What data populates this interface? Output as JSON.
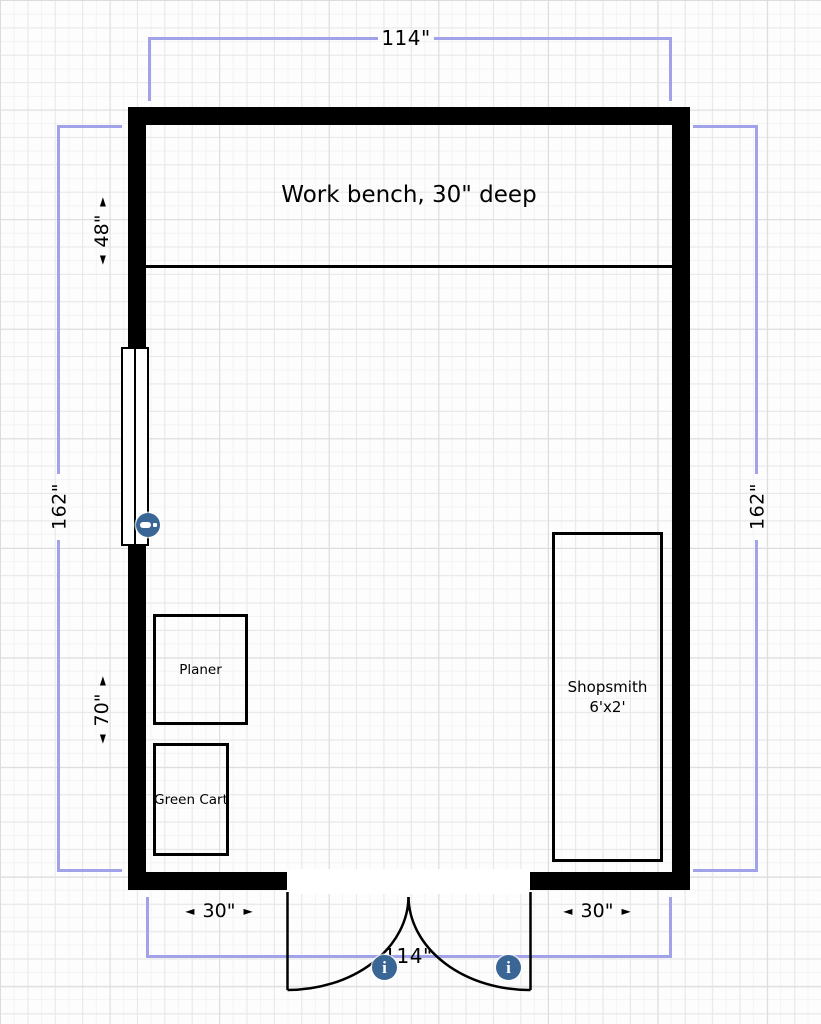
{
  "canvas": {
    "width": 821,
    "height": 1024
  },
  "colors": {
    "wall": "#000000",
    "dimension_line": "#a2a2e8",
    "marker_blue": "#3a6695",
    "background_grid": "#e8e8e8"
  },
  "furniture": {
    "workbench": {
      "label": "Work bench, 30\" deep"
    },
    "planer": {
      "label": "Planer"
    },
    "green_cart": {
      "label": "Green Cart"
    },
    "shopsmith": {
      "line1": "Shopsmith",
      "line2": "6'x2'"
    }
  },
  "dimensions": {
    "top_width": "114\"",
    "bottom_width": "114\"",
    "left_height": "162\"",
    "right_height": "162\"",
    "bench_depth": "48\"",
    "left_lower": "70\"",
    "bottom_left": "30\"",
    "bottom_right": "30\""
  },
  "icons": {
    "arrow_left": "◄",
    "arrow_right": "►",
    "info": "i"
  }
}
